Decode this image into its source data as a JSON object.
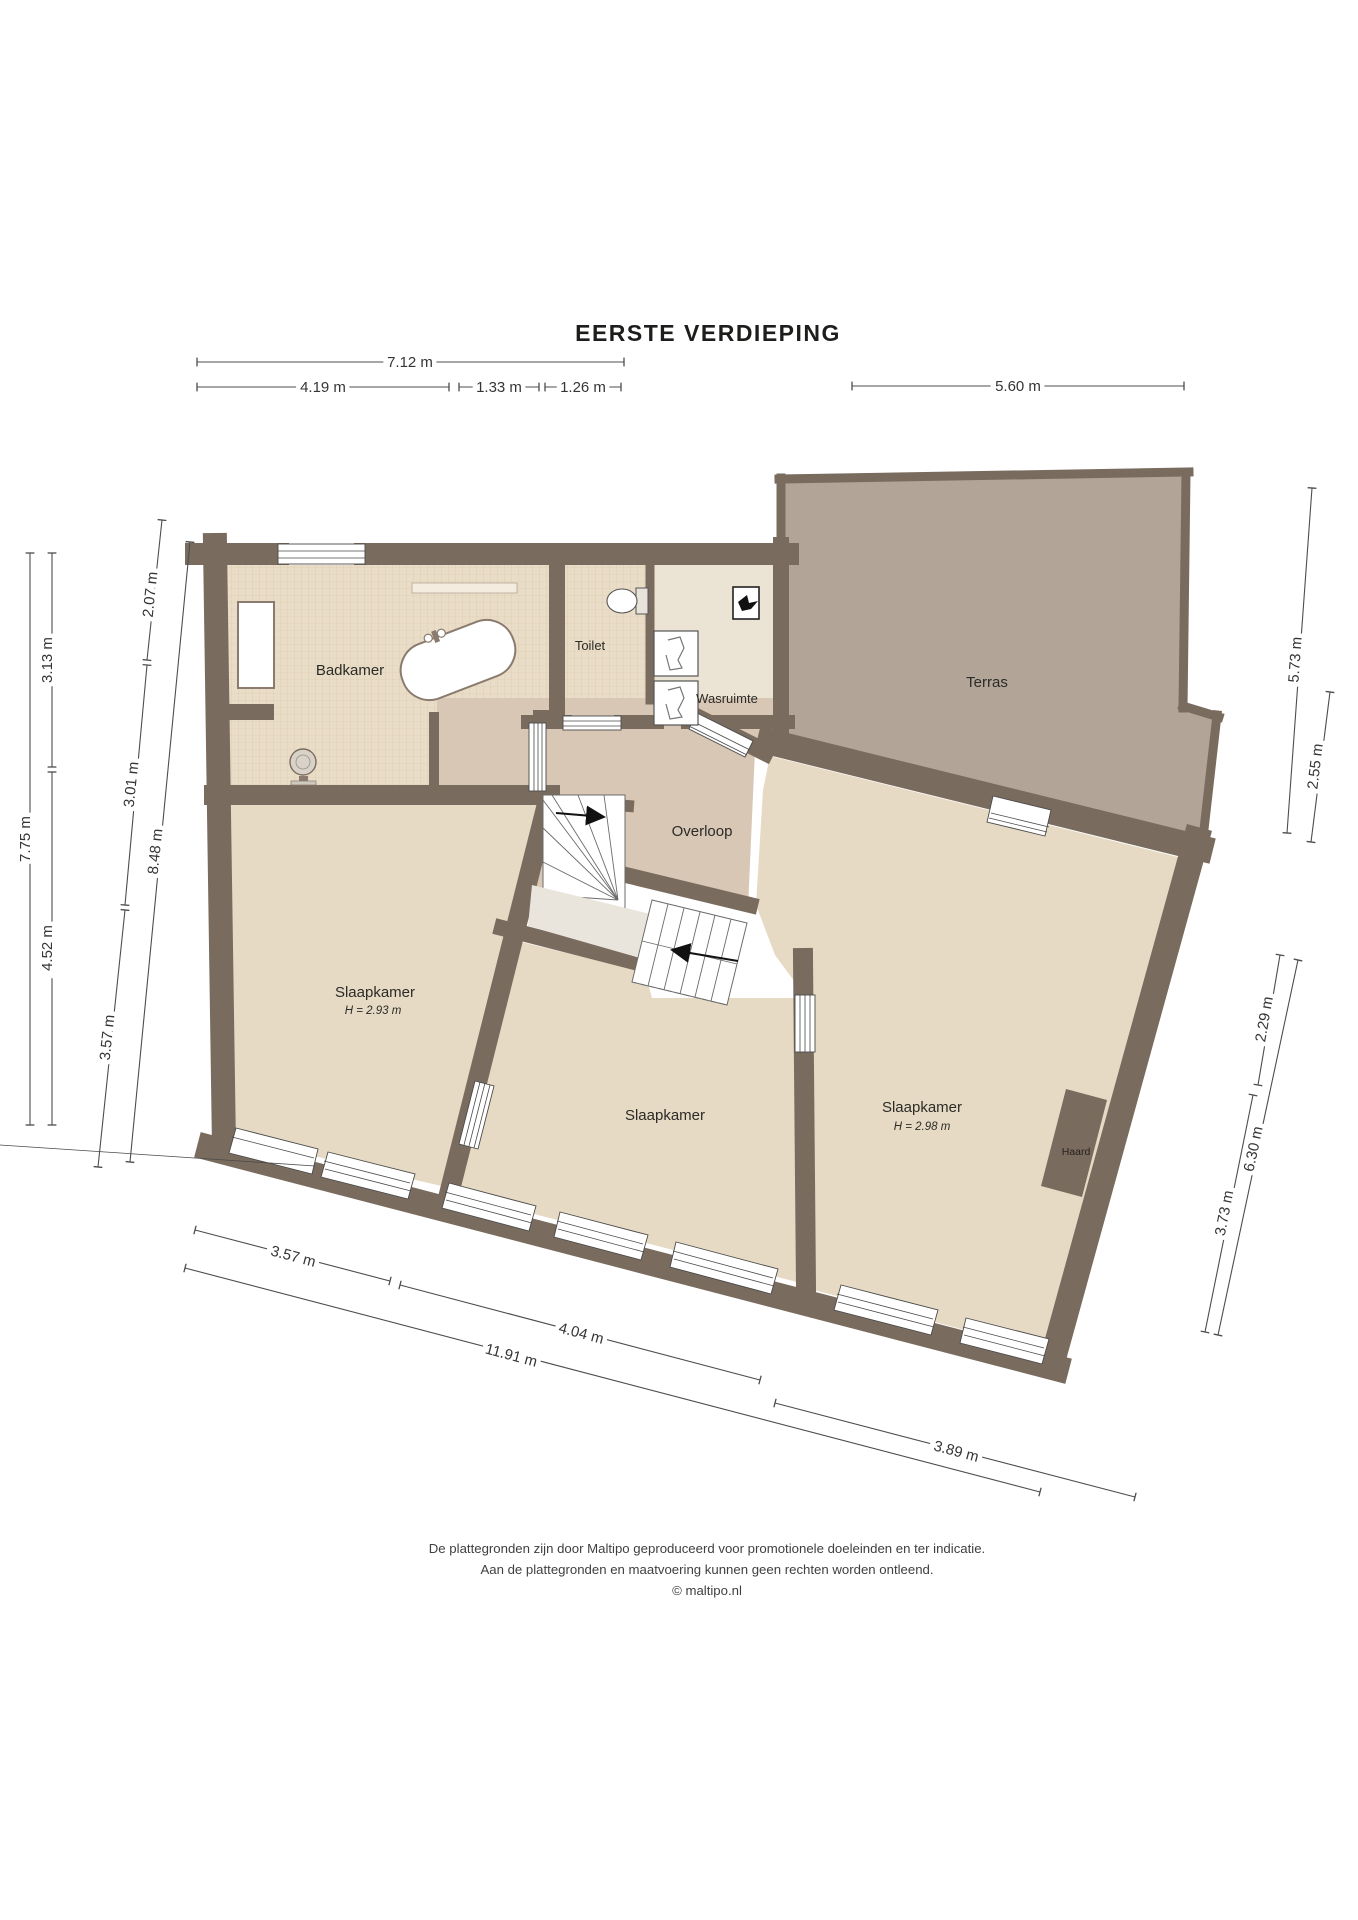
{
  "title": "EERSTE VERDIEPING",
  "rooms": {
    "badkamer": "Badkamer",
    "toilet": "Toilet",
    "wasruimte": "Wasruimte",
    "terras": "Terras",
    "overloop": "Overloop",
    "slaapkamer_links": "Slaapkamer",
    "slaapkamer_links_hoogte": "H = 2.93 m",
    "slaapkamer_midden": "Slaapkamer",
    "slaapkamer_rechts": "Slaapkamer",
    "slaapkamer_rechts_hoogte": "H = 2.98 m",
    "haard": "Haard"
  },
  "dimensions": {
    "top": [
      "7.12 m",
      "4.19 m",
      "1.33 m",
      "1.26 m",
      "5.60 m"
    ],
    "left": [
      "2.07 m",
      "3.01 m",
      "3.57 m",
      "8.48 m",
      "3.13 m",
      "4.52 m",
      "7.75 m"
    ],
    "right": [
      "5.73 m",
      "2.55 m",
      "2.29 m",
      "6.30 m",
      "3.73 m"
    ],
    "bottom": [
      "3.57 m",
      "4.04 m",
      "11.91 m",
      "3.89 m"
    ]
  },
  "footer": {
    "line1": "De plattegronden zijn door Maltipo geproduceerd voor promotionele doeleinden en ter indicatie.",
    "line2": "Aan de plattegronden en maatvoering kunnen geen rechten worden ontleend.",
    "line3": "© maltipo.nl"
  },
  "colors": {
    "wall": "#7a6b5f",
    "bedroom_floor": "#e7dac4",
    "hall_floor": "#d8c7b5",
    "laundry_floor": "#ebe3d3",
    "terrace_floor": "#b2a598",
    "tile_floor": "#eaddc7"
  }
}
